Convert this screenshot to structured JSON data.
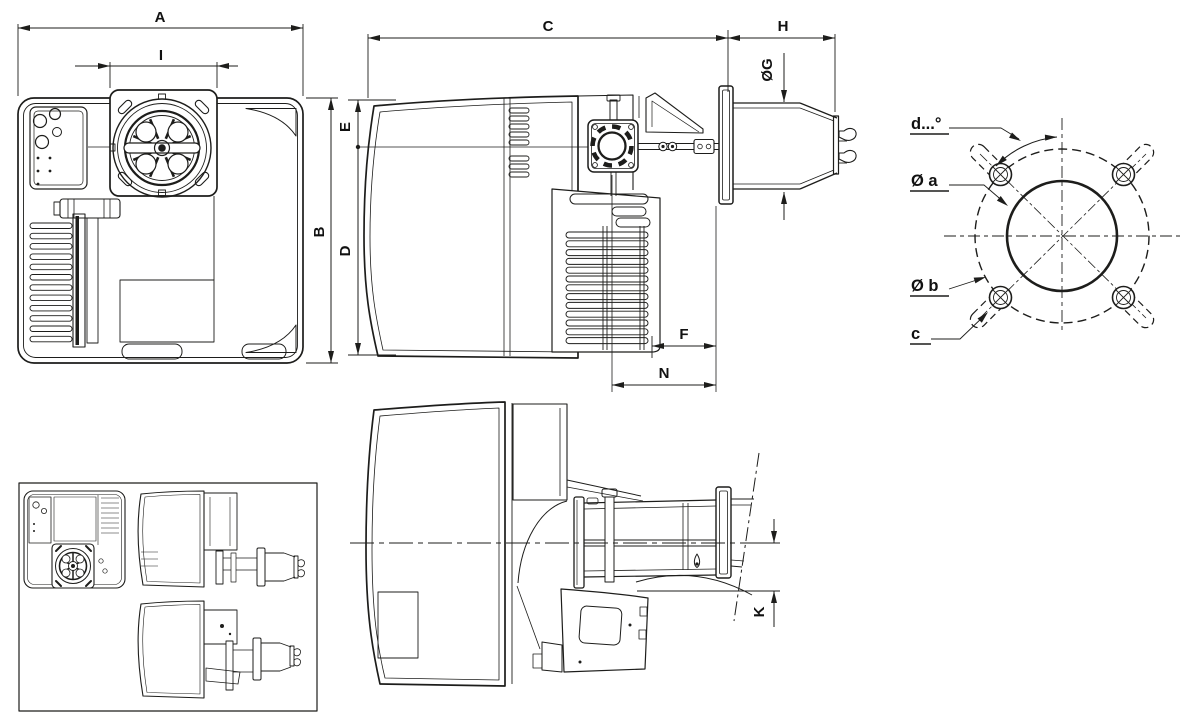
{
  "drawing": {
    "dimensions": {
      "A": "A",
      "B": "B",
      "C": "C",
      "D": "D",
      "E": "E",
      "F": "F",
      "G": "ØG",
      "H": "H",
      "I": "I",
      "K": "K",
      "N": "N"
    },
    "flange_detail": {
      "angle_label": "d...°",
      "inner_diameter_label": "Ø a",
      "bolt_circle_label": "Ø b",
      "slot_label": "c"
    },
    "line_color": "#1d1d1b",
    "background": "#ffffff"
  }
}
